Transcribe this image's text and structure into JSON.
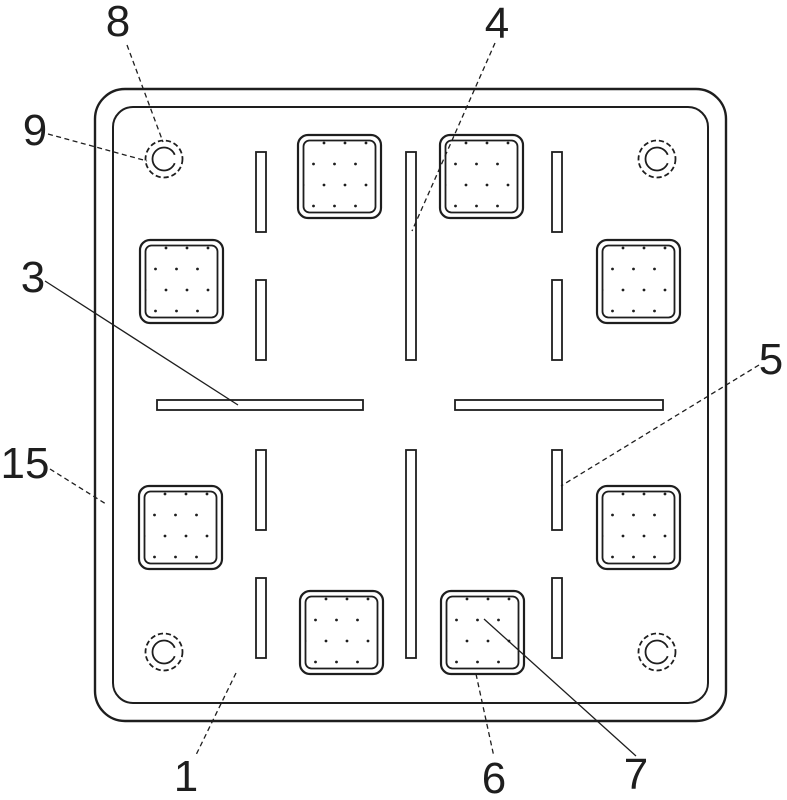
{
  "colors": {
    "line": "#1e1e1e",
    "background": "#ffffff"
  },
  "labels": [
    {
      "text": "8"
    },
    {
      "text": "9"
    },
    {
      "text": "3"
    },
    {
      "text": "15"
    },
    {
      "text": "4"
    },
    {
      "text": "5"
    },
    {
      "text": "1"
    },
    {
      "text": "6"
    },
    {
      "text": "7"
    }
  ]
}
